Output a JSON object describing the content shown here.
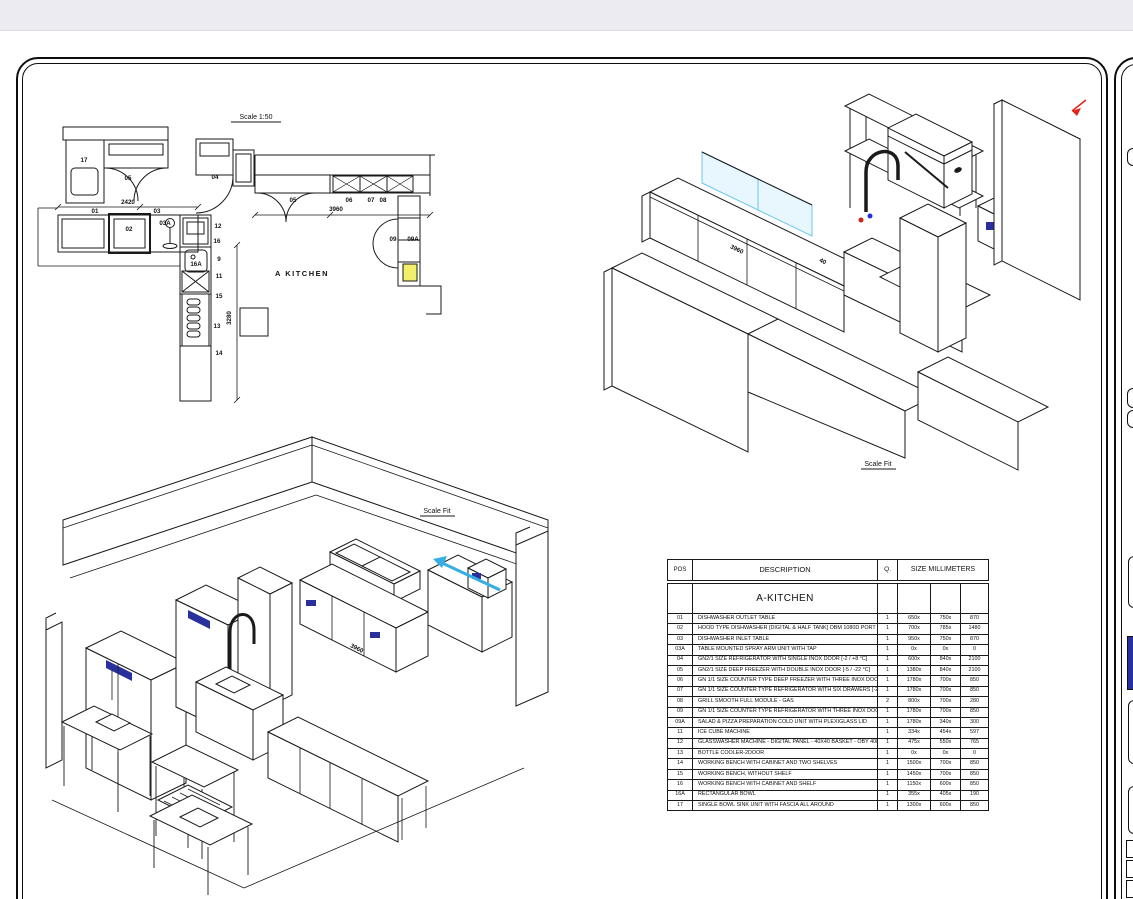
{
  "window": {
    "top_bar_label": ""
  },
  "colors": {
    "accent_cyan": "#35aee3",
    "accent_blue": "#2a2f9e",
    "marker_red": "#e32119",
    "highlight_yellow": "#f2ef6a",
    "topbar_grey": "#ebebf1"
  },
  "sheet": {
    "plan": {
      "scale_label": "Scale 1:50",
      "room_label": "A KITCHEN",
      "labels": [
        {
          "t": "17",
          "x": 84,
          "y": 162
        },
        {
          "t": "05",
          "x": 128,
          "y": 180
        },
        {
          "t": "04",
          "x": 215,
          "y": 179
        },
        {
          "t": "2420",
          "x": 128,
          "y": 204
        },
        {
          "t": "01",
          "x": 95,
          "y": 213
        },
        {
          "t": "03",
          "x": 157,
          "y": 213
        },
        {
          "t": "02",
          "x": 129,
          "y": 231
        },
        {
          "t": "03A",
          "x": 165,
          "y": 225
        },
        {
          "t": "12",
          "x": 218,
          "y": 228
        },
        {
          "t": "16",
          "x": 217,
          "y": 243
        },
        {
          "t": "16A",
          "x": 196,
          "y": 266
        },
        {
          "t": "9",
          "x": 219,
          "y": 261
        },
        {
          "t": "11",
          "x": 219,
          "y": 278
        },
        {
          "t": "15",
          "x": 219,
          "y": 298
        },
        {
          "t": "13",
          "x": 217,
          "y": 328
        },
        {
          "t": "14",
          "x": 219,
          "y": 355
        },
        {
          "t": "3280",
          "x": 231,
          "y": 318,
          "r": -90
        },
        {
          "t": "05",
          "x": 293,
          "y": 202
        },
        {
          "t": "06",
          "x": 349,
          "y": 202
        },
        {
          "t": "07",
          "x": 371,
          "y": 202
        },
        {
          "t": "08",
          "x": 383,
          "y": 202
        },
        {
          "t": "3960",
          "x": 336,
          "y": 211
        },
        {
          "t": "09",
          "x": 393,
          "y": 241
        },
        {
          "t": "09A",
          "x": 413,
          "y": 241
        }
      ]
    },
    "iso_top": {
      "scale_label": "Scale Fit",
      "labels": [
        {
          "t": "3960",
          "x": 736,
          "y": 251,
          "r": 26
        },
        {
          "t": "40",
          "x": 822,
          "y": 263,
          "r": 26
        }
      ]
    },
    "iso_bottom": {
      "scale_label": "Scale Fit",
      "labels": [
        {
          "t": "3960",
          "x": 356,
          "y": 650,
          "r": 27
        }
      ]
    },
    "table": {
      "headers": {
        "pos": "POS",
        "description": "DESCRIPTION",
        "qty": "Q.",
        "size": "SIZE MILLIMETERS"
      },
      "section_title": "A-KITCHEN",
      "rows": [
        {
          "pos": "01",
          "desc": "DISHWASHER OUTLET TABLE",
          "qty": "1",
          "w": "650x",
          "d": "750x",
          "h": "870"
        },
        {
          "pos": "02",
          "desc": "HOOD TYPE DISHWASHER [DIGITAL & HALF TANK] OBM 1080D PORT",
          "qty": "1",
          "w": "700x",
          "d": "785x",
          "h": "1480"
        },
        {
          "pos": "03",
          "desc": "DISHWASHER INLET TABLE",
          "qty": "1",
          "w": "950x",
          "d": "750x",
          "h": "870"
        },
        {
          "pos": "03A",
          "desc": "TABLE MOUNTED SPRAY ARM UNIT WITH TAP",
          "qty": "1",
          "w": "0x",
          "d": "0x",
          "h": "0"
        },
        {
          "pos": "04",
          "desc": "GN2/1 SIZE REFRIGERATOR WITH SINGLE INOX DOOR [-2 / +8 °C]",
          "qty": "1",
          "w": "600x",
          "d": "840x",
          "h": "2100"
        },
        {
          "pos": "05",
          "desc": "GN2/1 SIZE DEEP FREEZER WITH DOUBLE INOX DOOR [-5 / -22 °C]",
          "qty": "1",
          "w": "1380x",
          "d": "840x",
          "h": "2100"
        },
        {
          "pos": "06",
          "desc": "GN 1/1 SIZE COUNTER TYPE DEEP FREEZER WITH THREE INOX DOOR [-5 / -22 °C]",
          "qty": "1",
          "w": "1780x",
          "d": "700x",
          "h": "850"
        },
        {
          "pos": "07",
          "desc": "GN 1/1 SIZE COUNTER TYPE REFRIGERATOR WITH SIX DRAWERS [-2 / +8 °C]",
          "qty": "1",
          "w": "1780x",
          "d": "700x",
          "h": "850"
        },
        {
          "pos": "08",
          "desc": "GRILL SMOOTH FULL MODULE - GAS",
          "qty": "2",
          "w": "800x",
          "d": "700x",
          "h": "280"
        },
        {
          "pos": "09",
          "desc": "GN 1/1 SIZE COUNTER TYPE REFRIGERATOR WITH THREE INOX DOOR [-2 / +8 °C]",
          "qty": "1",
          "w": "1780x",
          "d": "700x",
          "h": "850"
        },
        {
          "pos": "09A",
          "desc": "SALAD & PIZZA PREPARATION COLD UNIT WITH PLEXIGLASS LID",
          "qty": "1",
          "w": "1780x",
          "d": "340x",
          "h": "300"
        },
        {
          "pos": "11",
          "desc": "ICE CUBE MACHINE",
          "qty": "1",
          "w": "334x",
          "d": "454x",
          "h": "597"
        },
        {
          "pos": "12",
          "desc": "GLASSWASHER MACHINE - DIGITAL PANEL - 40X40 BASKET - OBY 40D POT",
          "qty": "1",
          "w": "475x",
          "d": "550x",
          "h": "765"
        },
        {
          "pos": "13",
          "desc": "BOTTLE COOLER-2DOOR",
          "qty": "1",
          "w": "0x",
          "d": "0x",
          "h": "0"
        },
        {
          "pos": "14",
          "desc": "WORKING BENCH WITH CABINET AND TWO SHELVES",
          "qty": "1",
          "w": "1500x",
          "d": "700x",
          "h": "850"
        },
        {
          "pos": "15",
          "desc": "WORKING BENCH, WITHOUT SHELF",
          "qty": "1",
          "w": "1450x",
          "d": "700x",
          "h": "850"
        },
        {
          "pos": "16",
          "desc": "WORKING BENCH WITH CABINET AND SHELF",
          "qty": "1",
          "w": "1150x",
          "d": "600x",
          "h": "850"
        },
        {
          "pos": "16A",
          "desc": "RECTANGULAR BOWL",
          "qty": "1",
          "w": "355x",
          "d": "405x",
          "h": "190"
        },
        {
          "pos": "17",
          "desc": "SINGLE BOWL SINK UNIT WITH FASCIA ALL AROUND",
          "qty": "1",
          "w": "1300x",
          "d": "600x",
          "h": "850"
        }
      ]
    }
  }
}
